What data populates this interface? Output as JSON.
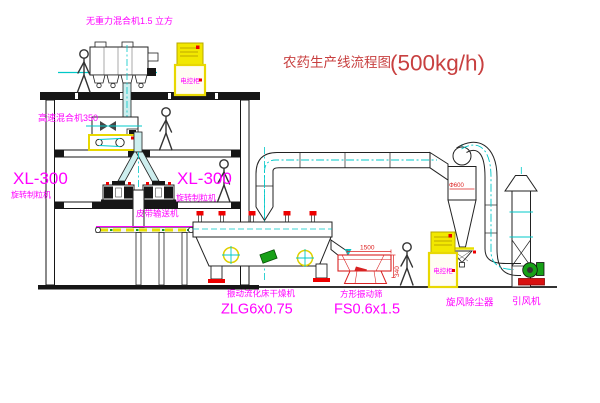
{
  "title": {
    "name": "农药生产线流程图",
    "capacity": "(500kg/h)"
  },
  "equipment": {
    "gravity_mixer": {
      "label": "无重力混合机1.5 立方"
    },
    "high_speed_mixer": {
      "label": "高速混合机350"
    },
    "granulator_left": {
      "model": "XL-300",
      "name": "旋转制粒机"
    },
    "granulator_right": {
      "model": "XL-300",
      "name": "旋转制粒机"
    },
    "belt_conveyor": {
      "label": "皮带输送机"
    },
    "fluid_bed_dryer": {
      "name": "振动流化床干燥机",
      "model": "ZLG6x0.75"
    },
    "square_sieve": {
      "name": "方形振动筛",
      "model": "FS0.6x1.5"
    },
    "cyclone": {
      "name": "旋风除尘器"
    },
    "fan": {
      "name": "引风机"
    },
    "control_cabinet_1": {
      "label": "电控柜"
    },
    "control_cabinet_2": {
      "label": "电控柜"
    }
  },
  "dimensions": {
    "sieve_width": "1500",
    "sieve_height": "340",
    "cyclone_dia": "Φ600"
  },
  "colors": {
    "label": "#ff00ff",
    "title": "#c84040",
    "line": "#222222",
    "centerline": "#00c8c8",
    "highlight": "#f2e800",
    "accent_red": "#ee0000",
    "accent_green": "#17a017"
  }
}
